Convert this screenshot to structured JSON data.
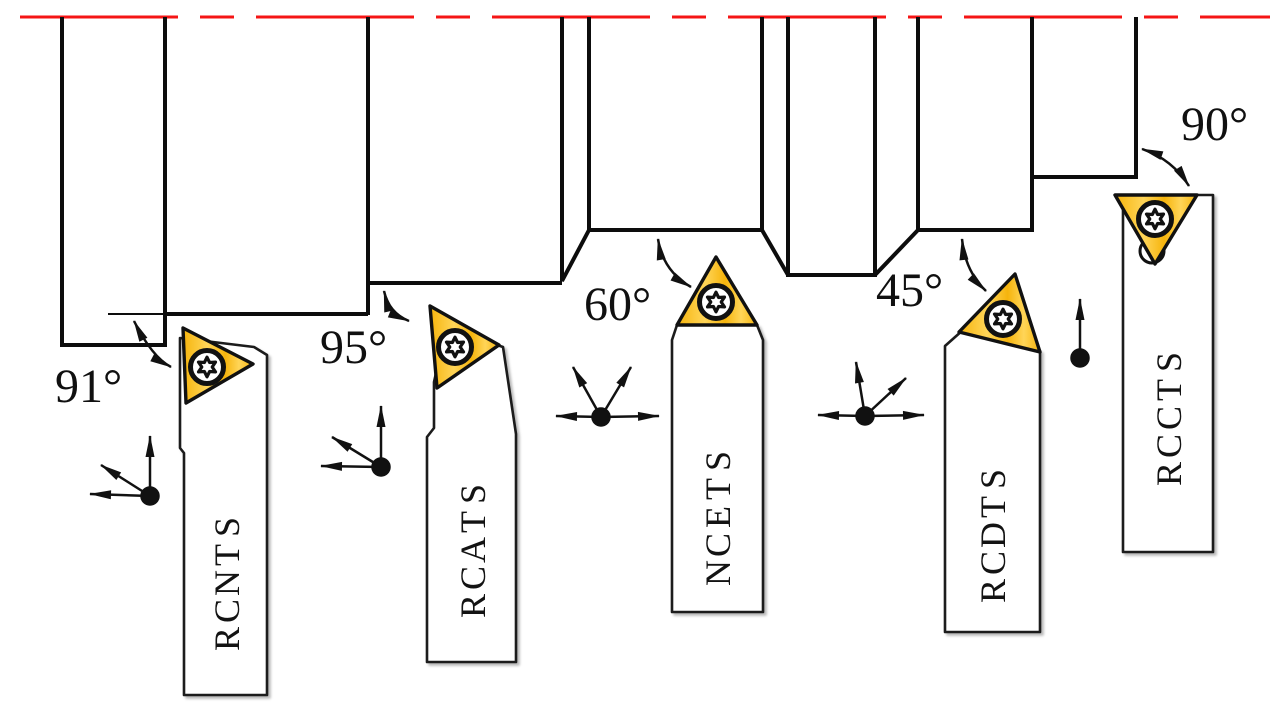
{
  "colors": {
    "background": "#ffffff",
    "line-black": "#111111",
    "centerline-red": "#f51515",
    "insert-yellow": "#f6b40c",
    "insert-yellow-light": "#ffd558"
  },
  "centerline": {
    "name": "workpiece-axis-centerline",
    "style": "dashed",
    "color": "#f51515"
  },
  "tools": [
    {
      "name": "STNCR",
      "angle_label": "91°",
      "feed_directions": [
        "up",
        "upper-left",
        "left"
      ]
    },
    {
      "name": "STACR",
      "angle_label": "95°",
      "feed_directions": [
        "up",
        "upper-left",
        "left"
      ]
    },
    {
      "name": "STECN",
      "angle_label": "60°",
      "feed_directions": [
        "left",
        "right",
        "upper-left",
        "upper-right"
      ]
    },
    {
      "name": "STDCR",
      "angle_label": "45°",
      "feed_directions": [
        "left",
        "right",
        "up",
        "upper-right"
      ]
    },
    {
      "name": "STCCR",
      "angle_label": "90°",
      "feed_directions": [
        "up"
      ]
    }
  ],
  "icons": {
    "screw": "torx-screw-icon",
    "insert": "triangular-carbide-insert-icon",
    "feed": "feed-direction-arrows-icon",
    "axis": "centerline-dashed-red",
    "angle_arrow": "double-headed-arc-arrow-icon"
  }
}
